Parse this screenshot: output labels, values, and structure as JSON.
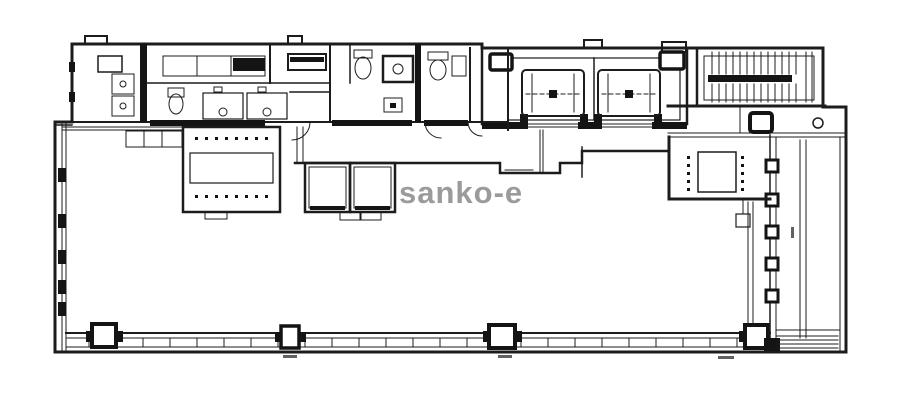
{
  "watermark": {
    "text": "sanko-e",
    "color": "#9b9b9b"
  },
  "drawing": {
    "type": "architectural floor plan",
    "background": "#ffffff",
    "line_color": "#1c1c1c",
    "wall_color": "#141414",
    "visible_text": [
      "sanko-e"
    ]
  }
}
